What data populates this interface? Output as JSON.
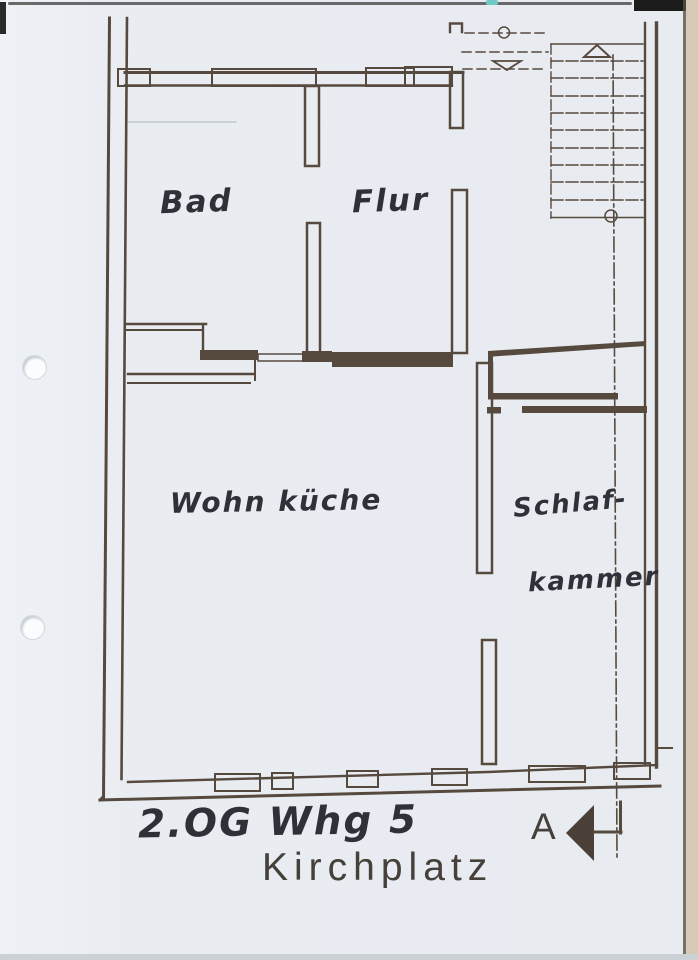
{
  "rooms": [
    {
      "name": "Bad"
    },
    {
      "name": "Flur"
    },
    {
      "name": "Wohn küche"
    },
    {
      "name_top": "Schlaf-",
      "name_bottom": "kammer"
    }
  ],
  "annotations": {
    "floor_unit": "2.OG Whg 5",
    "street": "Kirchplatz",
    "section_marker": "A"
  },
  "colors": {
    "paper": "#e9edf2",
    "ink": "#56493e",
    "handwriting": "#2f3138",
    "lettering_ink": "#45403a",
    "scan_edge_tan": "#d6cab4"
  }
}
